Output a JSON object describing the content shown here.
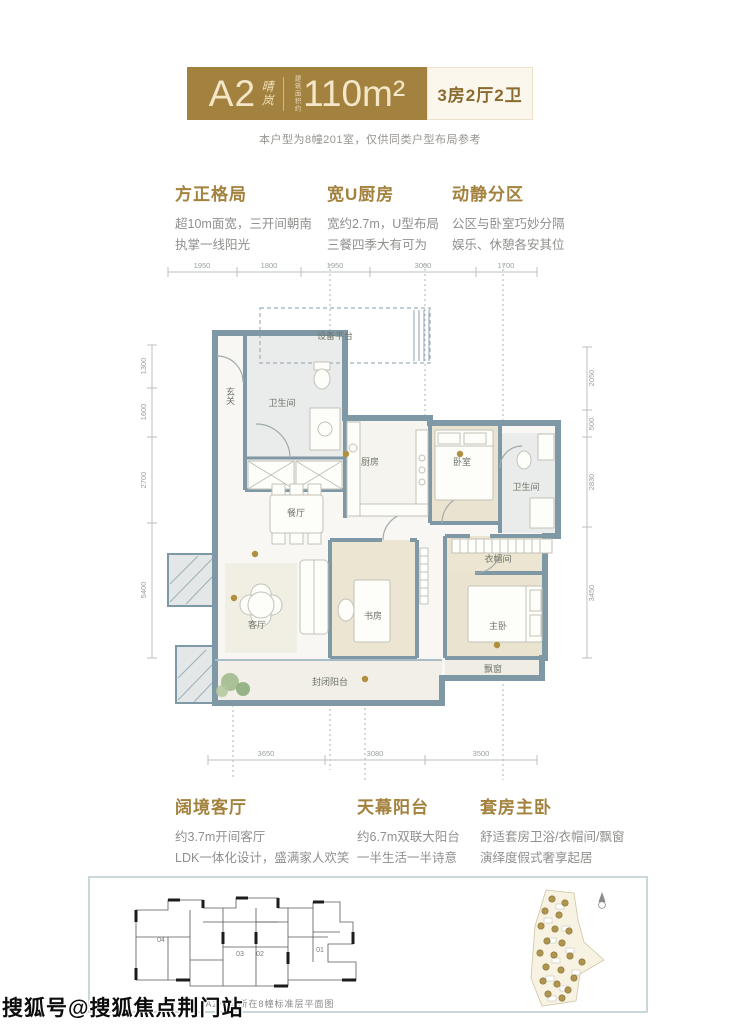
{
  "header": {
    "unit": "A2",
    "seal": "晴岚",
    "area_prefix": "建筑面积约",
    "area": "110m²",
    "layout": "3房2厅2卫",
    "disclaimer": "本户型为8幢201室，仅供同类户型布局参考"
  },
  "features_top": [
    {
      "title": "方正格局",
      "line1": "超10m面宽，三开间朝南",
      "line2": "执掌一线阳光"
    },
    {
      "title": "宽U厨房",
      "line1": "宽约2.7m，U型布局",
      "line2": "三餐四季大有可为"
    },
    {
      "title": "动静分区",
      "line1": "公区与卧室巧妙分隔",
      "line2": "娱乐、休憩各安其位"
    }
  ],
  "features_bottom": [
    {
      "title": "阔境客厅",
      "line1": "约3.7m开间客厅",
      "line2": "LDK一体化设计，盛满家人欢笑"
    },
    {
      "title": "天幕阳台",
      "line1": "约6.7m双联大阳台",
      "line2": "一半生活一半诗意"
    },
    {
      "title": "套房主卧",
      "line1": "舒适套房卫浴/衣帽间/飘窗",
      "line2": "演绎度假式奢享起居"
    }
  ],
  "floorplan": {
    "dims_top": [
      "1950",
      "1800",
      "1950",
      "3000",
      "1700"
    ],
    "dims_bottom": [
      "3650",
      "3080",
      "3500"
    ],
    "dims_left": [
      "1300",
      "1600",
      "2700",
      "5400"
    ],
    "dims_right": [
      "2050",
      "500",
      "2830",
      "3450"
    ],
    "rooms": {
      "equipment": "设备平台",
      "bath1": "卫生间",
      "entry": "玄关",
      "kitchen": "厨房",
      "bedroom": "卧室",
      "bath2": "卫生间",
      "closet": "衣帽间",
      "dining": "餐厅",
      "living": "客厅",
      "study": "书房",
      "master": "主卧",
      "balcony": "封闭阳台",
      "bay": "飘窗"
    }
  },
  "footer": {
    "caption": "A2户型所在8幢标准层平面图",
    "units": [
      "04",
      "03",
      "02",
      "01"
    ]
  },
  "watermark": "搜狐号@搜狐焦点荆门站",
  "colors": {
    "brand": "#a3813f",
    "cream_box": "#fbf7ec",
    "wall": "#7e98a6",
    "bedroom_floor": "#eae3d0",
    "dim_text": "#9aa0a0"
  }
}
